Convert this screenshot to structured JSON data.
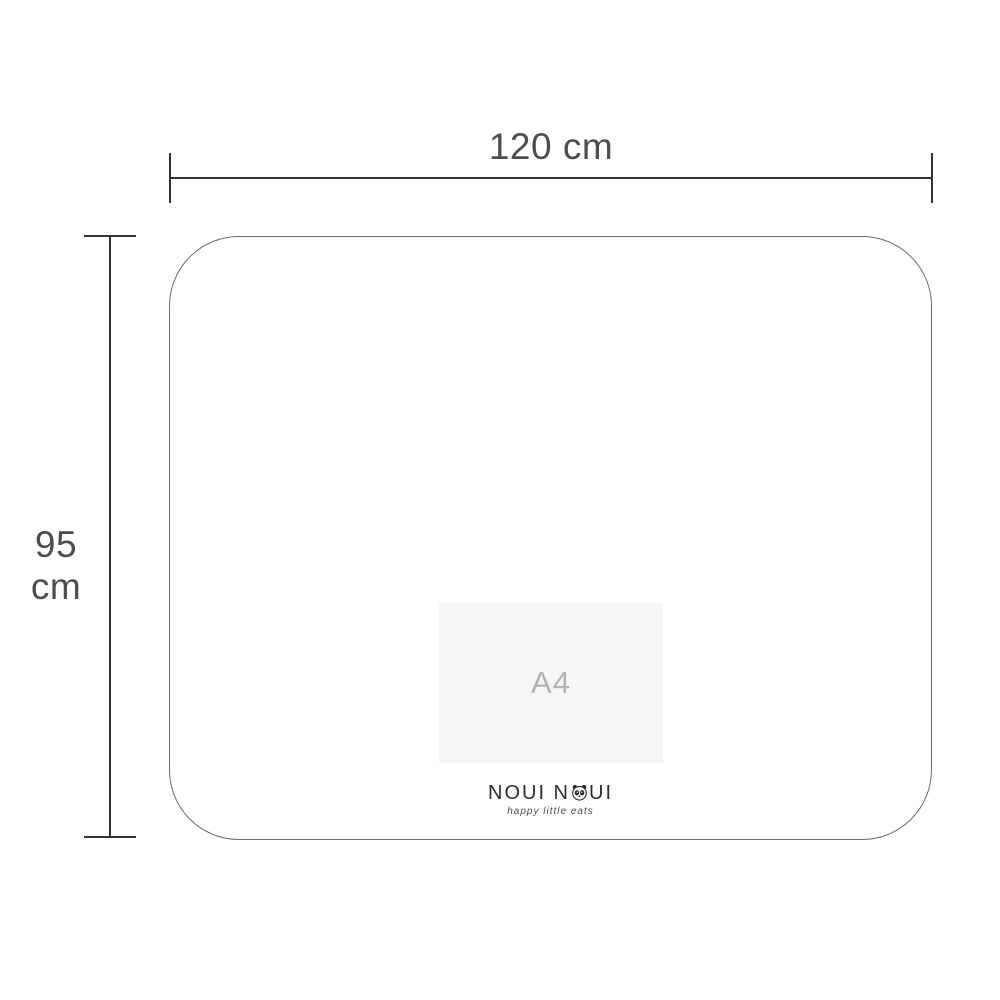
{
  "diagram": {
    "title": "mat-size-diagram",
    "width_label": "120 cm",
    "height_label": "95 cm",
    "a4_label": "A4",
    "mat_width_cm": 120,
    "mat_height_cm": 95
  },
  "logo": {
    "brand_left": "NOUI N",
    "brand_right": "UI",
    "tagline": "happy little eats"
  },
  "colors": {
    "background": "#ffffff",
    "dimension_line": "#333333",
    "dimension_text": "#4d4d4d",
    "mat_outline": "#6e6e6e",
    "a4_fill": "#f6f6f7",
    "a4_text": "#b2b5b7",
    "logo_text": "#2e2e2e"
  }
}
